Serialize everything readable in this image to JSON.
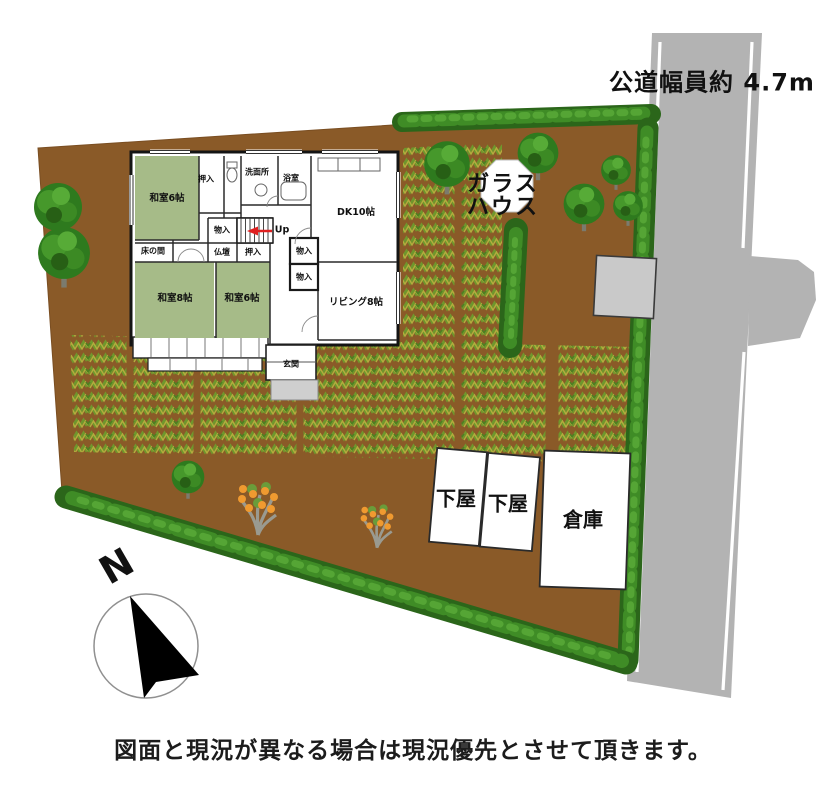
{
  "road": {
    "label": "公道幅員約 4.7m"
  },
  "greenhouse": {
    "line1": "ガラス",
    "line2": "ハウス"
  },
  "outbuildings": {
    "shed1": "下屋",
    "shed2": "下屋",
    "warehouse": "倉庫"
  },
  "compass": {
    "north": "N"
  },
  "caption": {
    "text": "図面と現況が異なる場合は現況優先とさせて頂きます。"
  },
  "floor_plan": {
    "washitsu6_upper": "和室6帖",
    "oshiire_upper": "押入",
    "senmenjo": "洗面所",
    "yokushitsu": "浴室",
    "dk": "DK10帖",
    "monoiri_stairs": "物入",
    "up": "Up",
    "tokonoma": "床の間",
    "butsudan": "仏壇",
    "oshiire_mid": "押入",
    "monoiri_1": "物入",
    "monoiri_2": "物入",
    "washitsu8": "和室8帖",
    "washitsu6_lower": "和室6帖",
    "living": "リビング8帖",
    "genkan": "玄関"
  },
  "colors": {
    "ground": "#8a5a28",
    "road": "#b3b3b3",
    "road_line": "#ffffff",
    "hedge_dark": "#2b661a",
    "hedge_mid": "#3f8c26",
    "hedge_light": "#55a535",
    "crop_green": "#6f972c",
    "crop_yellow": "#b3ad3e",
    "tatami": "#a6bb88",
    "tree_green": "#2e7a1e",
    "fruit_orange": "#f09a30",
    "building_gray": "#c9c9c9",
    "up_arrow_red": "#e02020"
  }
}
